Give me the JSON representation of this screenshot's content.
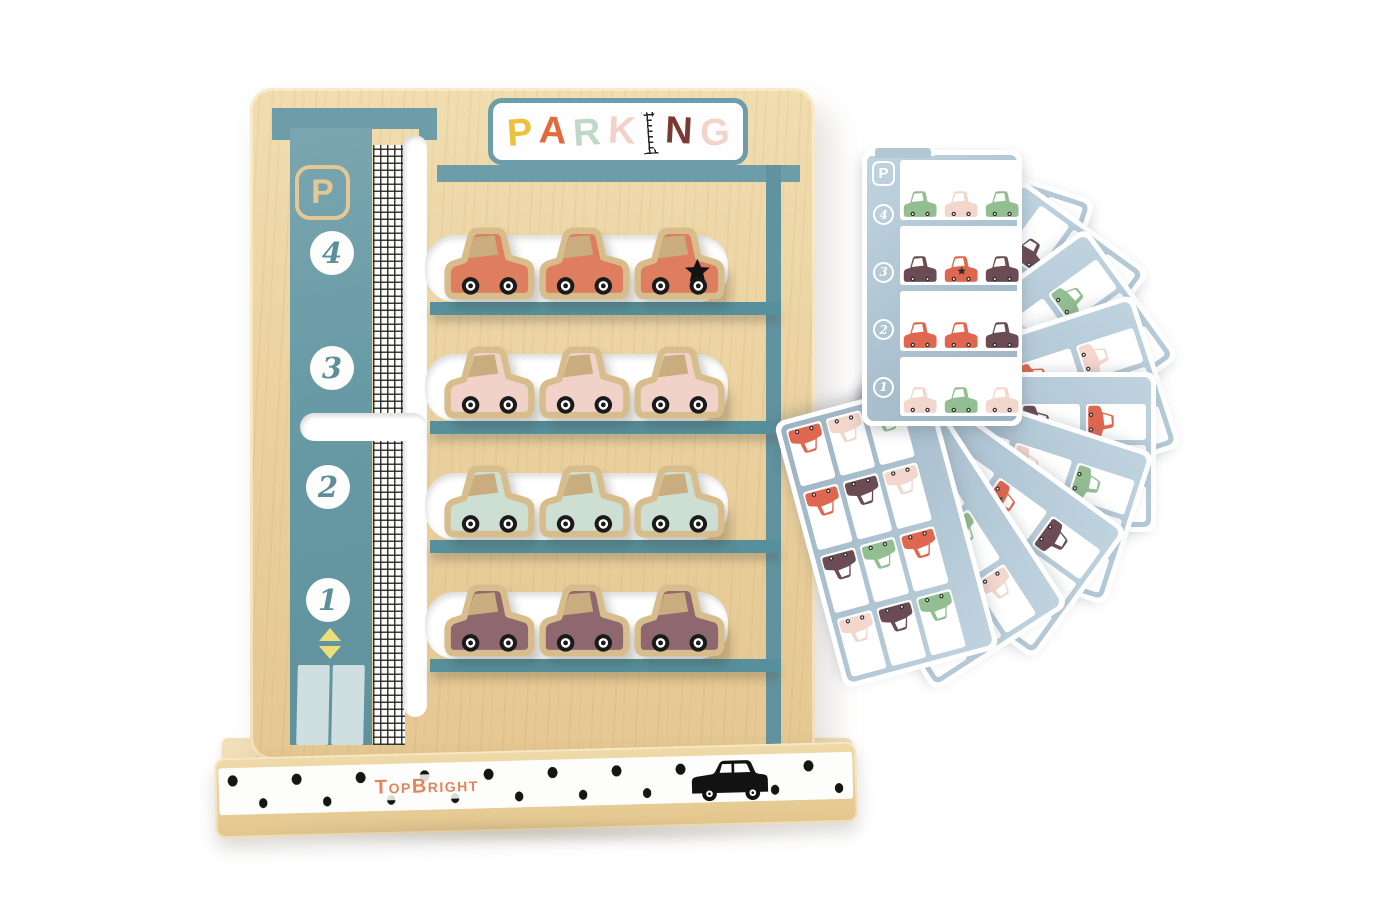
{
  "board": {
    "sign": {
      "word": "PARKING",
      "letters": [
        {
          "ch": "P",
          "color": "#ecc23d"
        },
        {
          "ch": "A",
          "color": "#e06a3c"
        },
        {
          "ch": "R",
          "color": "#bfd8c7"
        },
        {
          "ch": "K",
          "color": "#f2d2c8"
        },
        {
          "ch": "I",
          "color": "#262626",
          "pattern": "crosshatch"
        },
        {
          "ch": "N",
          "color": "#7a3a31"
        },
        {
          "ch": "G",
          "color": "#f3d4cb"
        }
      ]
    },
    "p_badge": "P",
    "floors": [
      "4",
      "3",
      "2",
      "1"
    ],
    "levels": [
      {
        "floor": "4",
        "color": "#de7e5f",
        "stars": [
          2
        ]
      },
      {
        "floor": "3",
        "color": "#f1d2c9",
        "stars": []
      },
      {
        "floor": "2",
        "color": "#cddfd2",
        "stars": []
      },
      {
        "floor": "1",
        "color": "#8e686e",
        "stars": []
      }
    ],
    "colors": {
      "teal": "#6c9da8",
      "shelf": "#56909c",
      "wood": "#ecd3a2",
      "car_trim": "#d8bd8c"
    }
  },
  "base": {
    "brand_parts": [
      {
        "text": "T",
        "big": true
      },
      {
        "text": "OP",
        "big": false
      },
      {
        "text": "B",
        "big": true
      },
      {
        "text": "RIGHT",
        "big": false
      }
    ],
    "brand_color": "#e2855f"
  },
  "cards": {
    "palette": {
      "green": "#93be92",
      "pink": "#f3d6cc",
      "red": "#e0674f",
      "plum": "#6b4c54"
    },
    "front": {
      "p_badge": "P",
      "floors": [
        "4",
        "3",
        "2",
        "1"
      ],
      "grid": [
        [
          "green",
          "pink",
          "green"
        ],
        [
          "plum",
          "red_star",
          "plum"
        ],
        [
          "red",
          "red",
          "plum"
        ],
        [
          "pink",
          "green",
          "pink"
        ]
      ]
    },
    "back": [
      {
        "rotation": 18,
        "grid": [
          [
            "pink",
            "green",
            "green"
          ],
          [
            "red",
            "plum",
            "pink"
          ],
          [
            "green",
            "red",
            "plum"
          ],
          [
            "pink",
            "plum",
            "green"
          ]
        ]
      },
      {
        "rotation": 36,
        "grid": [
          [
            "plum",
            "red",
            "pink"
          ],
          [
            "green",
            "pink",
            "red"
          ],
          [
            "plum",
            "green",
            "pink"
          ],
          [
            "red",
            "pink",
            "green"
          ]
        ]
      },
      {
        "rotation": 54,
        "grid": [
          [
            "green",
            "pink",
            "plum"
          ],
          [
            "pink",
            "red",
            "green"
          ],
          [
            "red_star",
            "plum",
            "pink"
          ],
          [
            "green",
            "pink",
            "red"
          ]
        ]
      },
      {
        "rotation": 72,
        "grid": [
          [
            "pink",
            "plum",
            "green"
          ],
          [
            "red",
            "green",
            "pink"
          ],
          [
            "plum",
            "pink",
            "red"
          ],
          [
            "green",
            "red",
            "plum"
          ]
        ]
      },
      {
        "rotation": 90,
        "grid": [
          [
            "red",
            "pink",
            "green"
          ],
          [
            "plum",
            "green",
            "red"
          ],
          [
            "pink",
            "red",
            "green"
          ],
          [
            "plum",
            "pink",
            "pink"
          ]
        ]
      },
      {
        "rotation": 108,
        "grid": [
          [
            "green",
            "red",
            "pink"
          ],
          [
            "pink",
            "plum",
            "green"
          ],
          [
            "red",
            "green",
            "plum"
          ],
          [
            "pink",
            "red",
            "green"
          ]
        ]
      },
      {
        "rotation": 126,
        "grid": [
          [
            "plum",
            "green",
            "red"
          ],
          [
            "red_star",
            "pink",
            "plum"
          ],
          [
            "green",
            "plum",
            "pink"
          ],
          [
            "red",
            "green",
            "pink"
          ]
        ]
      },
      {
        "rotation": 147,
        "grid": [
          [
            "pink",
            "red",
            "plum"
          ],
          [
            "green",
            "pink",
            "red"
          ],
          [
            "plum",
            "red",
            "green"
          ],
          [
            "pink",
            "green",
            "plum"
          ]
        ]
      },
      {
        "rotation": 165,
        "grid": [
          [
            "green",
            "plum",
            "pink"
          ],
          [
            "red",
            "green",
            "plum"
          ],
          [
            "pink",
            "plum",
            "red"
          ],
          [
            "green",
            "pink",
            "red"
          ]
        ]
      }
    ]
  }
}
